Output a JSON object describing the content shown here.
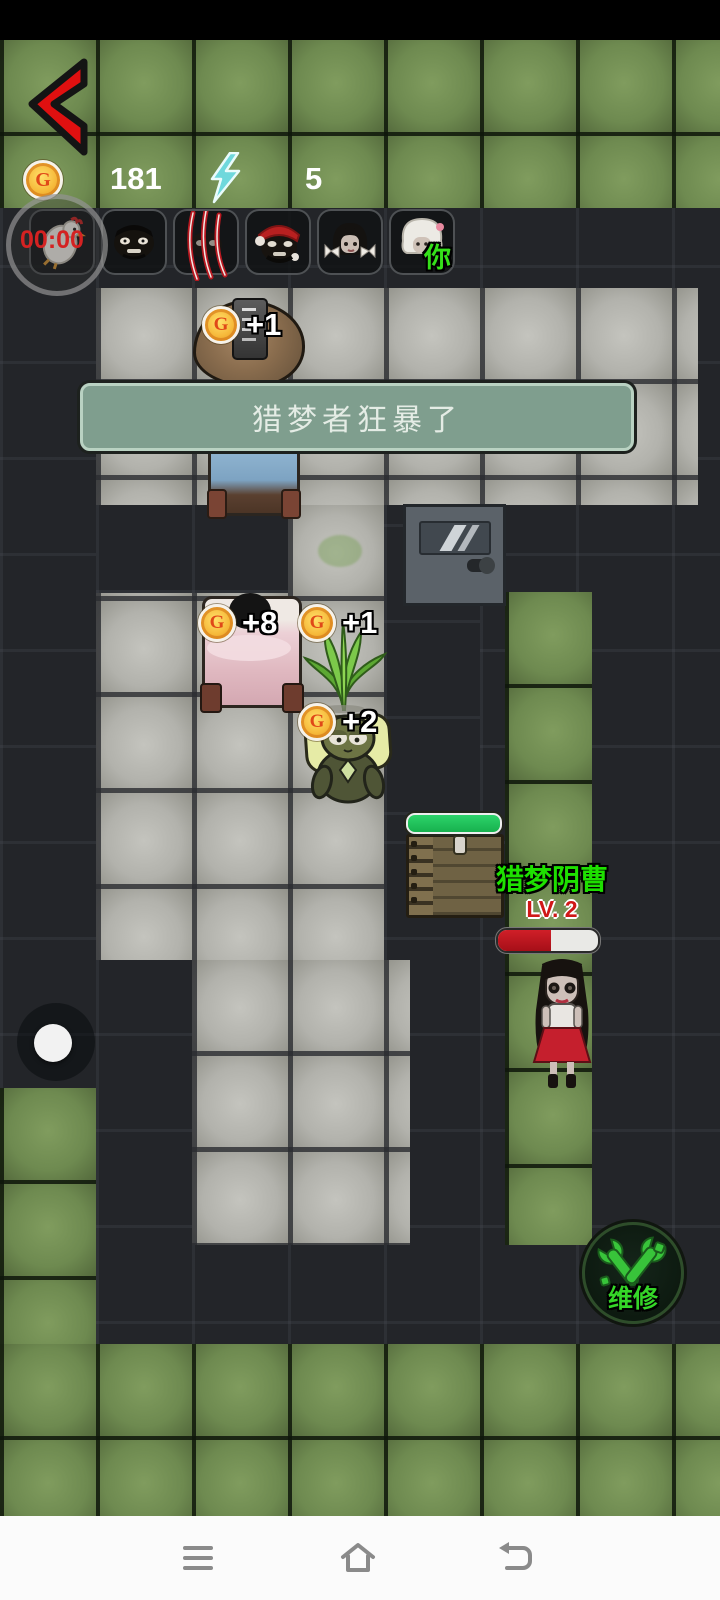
{
  "hud": {
    "coin_letter": "G",
    "coin_count": "181",
    "energy_count": "5",
    "timer": "00:00"
  },
  "banner": {
    "text": "猎梦者狂暴了"
  },
  "roster": {
    "slots": [
      {
        "name": "chicken"
      },
      {
        "name": "dark-face"
      },
      {
        "name": "claw-marked"
      },
      {
        "name": "santa-hat"
      },
      {
        "name": "bow-girl"
      },
      {
        "name": "white-hair",
        "tag": "你"
      }
    ]
  },
  "rewards": [
    {
      "coin": "G",
      "value": "+1"
    },
    {
      "coin": "G",
      "value": "+8"
    },
    {
      "coin": "G",
      "value": "+1"
    },
    {
      "coin": "G",
      "value": "+2"
    }
  ],
  "enemy": {
    "name": "猎梦阴曹",
    "level": "LV. 2",
    "hp_percent": 53
  },
  "crate": {
    "hp_percent": 100
  },
  "repair": {
    "label": "维修"
  },
  "colors": {
    "banner_bg": "#7f9e8e",
    "enemy_name_green": "#1ee000",
    "hp_red": "#c01420",
    "bar_green": "#21c55d"
  }
}
